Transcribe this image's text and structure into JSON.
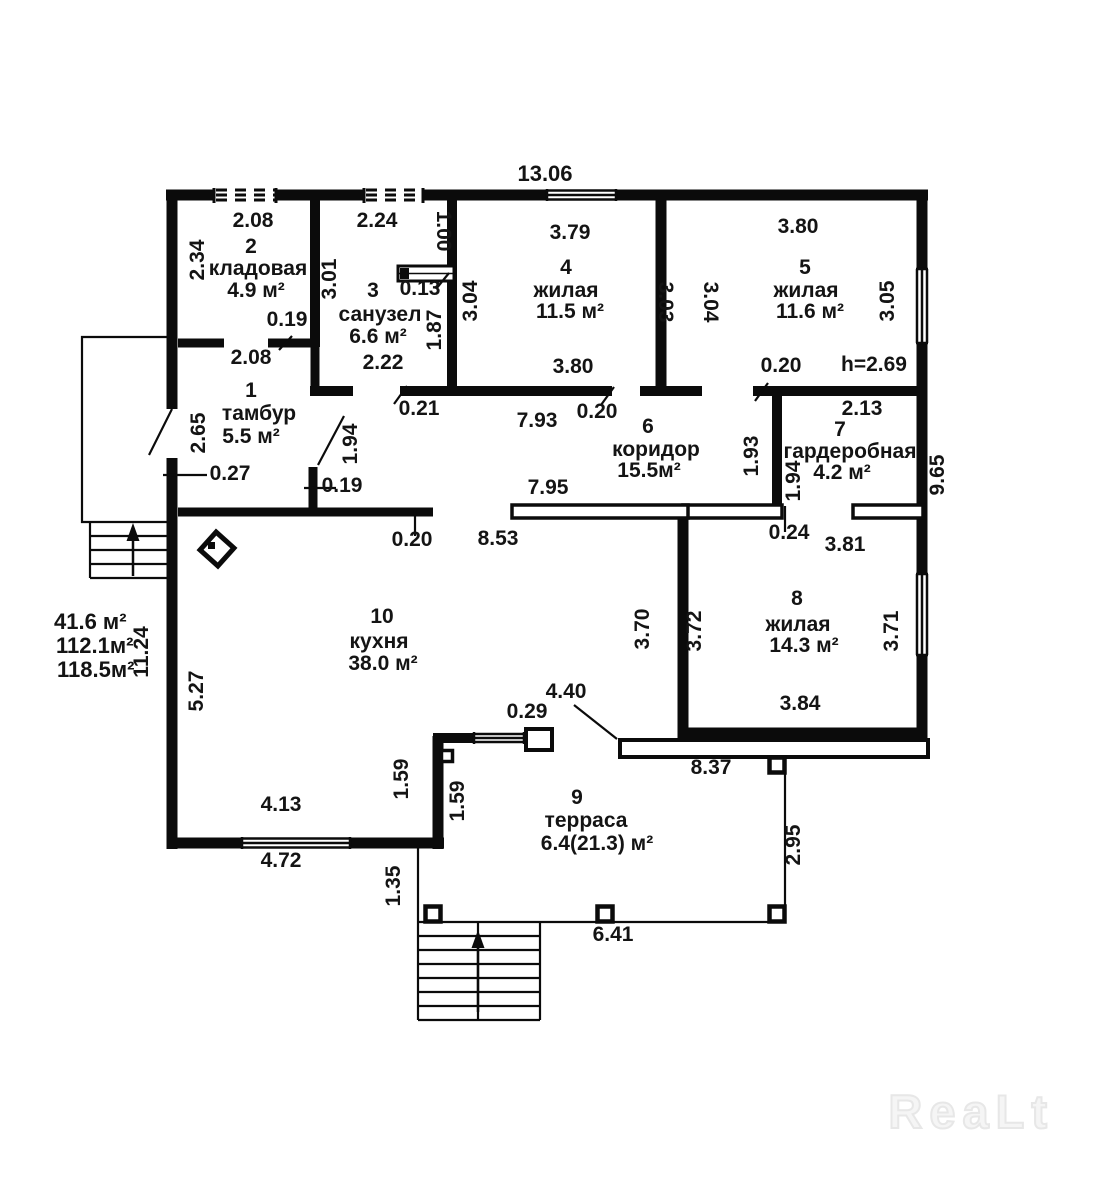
{
  "watermark": "ReaLt",
  "summary": {
    "building_areas": [
      "41.6 м²",
      "112.1м²",
      "118.5м²"
    ],
    "ceiling_height": "h=2.69"
  },
  "rooms": [
    {
      "number": "1",
      "name": "тамбур",
      "area": "5.5 м²"
    },
    {
      "number": "2",
      "name": "кладовая",
      "area": "4.9 м²"
    },
    {
      "number": "3",
      "name": "санузел",
      "area": "6.6 м²"
    },
    {
      "number": "4",
      "name": "жилая",
      "area": "11.5 м²"
    },
    {
      "number": "5",
      "name": "жилая",
      "area": "11.6 м²"
    },
    {
      "number": "6",
      "name": "коридор",
      "area": "15.5м²"
    },
    {
      "number": "7",
      "name": "гардеробная",
      "area": "4.2 м²"
    },
    {
      "number": "8",
      "name": "жилая",
      "area": "14.3 м²"
    },
    {
      "number": "9",
      "name": "терраса",
      "area": "6.4(21.3) м²"
    },
    {
      "number": "10",
      "name": "кухня",
      "area": "38.0 м²"
    }
  ],
  "labels": [
    {
      "t": "13.06",
      "x": 545,
      "y": 181,
      "s": 22
    },
    {
      "t": "2.08",
      "x": 253,
      "y": 227
    },
    {
      "t": "2.24",
      "x": 377,
      "y": 227
    },
    {
      "t": "1.00",
      "x": 437,
      "y": 231,
      "r": 90
    },
    {
      "t": "2.34",
      "x": 204,
      "y": 260,
      "r": -90
    },
    {
      "t": "2",
      "x": 251,
      "y": 253,
      "n": "room-number"
    },
    {
      "t": "кладовая",
      "x": 258,
      "y": 275,
      "n": "room-name"
    },
    {
      "t": "4.9 м²",
      "x": 256,
      "y": 297,
      "n": "room-area"
    },
    {
      "t": "3.01",
      "x": 336,
      "y": 279,
      "r": -90
    },
    {
      "t": "3",
      "x": 373,
      "y": 297,
      "n": "room-number"
    },
    {
      "t": "0.13",
      "x": 420,
      "y": 295
    },
    {
      "t": "санузел",
      "x": 380,
      "y": 321,
      "n": "room-name"
    },
    {
      "t": "6.6 м²",
      "x": 378,
      "y": 343,
      "n": "room-area"
    },
    {
      "t": "1.87",
      "x": 441,
      "y": 330,
      "r": -90
    },
    {
      "t": "0.19",
      "x": 287,
      "y": 326
    },
    {
      "t": "2.08",
      "x": 251,
      "y": 364
    },
    {
      "t": "2.22",
      "x": 383,
      "y": 369
    },
    {
      "t": "0.21",
      "x": 419,
      "y": 415
    },
    {
      "t": "1",
      "x": 251,
      "y": 397,
      "n": "room-number"
    },
    {
      "t": "тамбур",
      "x": 259,
      "y": 420,
      "n": "room-name"
    },
    {
      "t": "5.5 м²",
      "x": 251,
      "y": 443,
      "n": "room-area"
    },
    {
      "t": "2.65",
      "x": 205,
      "y": 433,
      "r": -90
    },
    {
      "t": "0.27",
      "x": 230,
      "y": 480
    },
    {
      "t": "1.94",
      "x": 357,
      "y": 444,
      "r": -90
    },
    {
      "t": "0.19",
      "x": 342,
      "y": 492
    },
    {
      "t": "3.04",
      "x": 477,
      "y": 301,
      "r": -90
    },
    {
      "t": "3.79",
      "x": 570,
      "y": 239
    },
    {
      "t": "4",
      "x": 566,
      "y": 274,
      "n": "room-number"
    },
    {
      "t": "жилая",
      "x": 566,
      "y": 297,
      "n": "room-name"
    },
    {
      "t": "11.5 м²",
      "x": 570,
      "y": 318,
      "n": "room-area"
    },
    {
      "t": "3.03",
      "x": 659,
      "y": 302,
      "r": 90
    },
    {
      "t": "3.04",
      "x": 704,
      "y": 302,
      "r": 90
    },
    {
      "t": "3.80",
      "x": 573,
      "y": 373
    },
    {
      "t": "0.20",
      "x": 597,
      "y": 418
    },
    {
      "t": "7.93",
      "x": 537,
      "y": 427
    },
    {
      "t": "3.80",
      "x": 798,
      "y": 233
    },
    {
      "t": "5",
      "x": 805,
      "y": 274,
      "n": "room-number"
    },
    {
      "t": "жилая",
      "x": 806,
      "y": 297,
      "n": "room-name"
    },
    {
      "t": "11.6 м²",
      "x": 810,
      "y": 318,
      "n": "room-area"
    },
    {
      "t": "3.05",
      "x": 894,
      "y": 301,
      "r": -90
    },
    {
      "t": "0.20",
      "x": 781,
      "y": 372
    },
    {
      "t": "h=2.69",
      "x": 874,
      "y": 371,
      "n": "ceiling-height"
    },
    {
      "t": "6",
      "x": 648,
      "y": 433,
      "n": "room-number"
    },
    {
      "t": "коридор",
      "x": 656,
      "y": 456,
      "n": "room-name"
    },
    {
      "t": "15.5м²",
      "x": 649,
      "y": 477,
      "n": "room-area"
    },
    {
      "t": "2.13",
      "x": 862,
      "y": 415
    },
    {
      "t": "7",
      "x": 840,
      "y": 436,
      "n": "room-number"
    },
    {
      "t": "гардеробная",
      "x": 850,
      "y": 458,
      "n": "room-name"
    },
    {
      "t": "4.2 м²",
      "x": 842,
      "y": 479,
      "n": "room-area"
    },
    {
      "t": "1.93",
      "x": 758,
      "y": 456,
      "r": -90
    },
    {
      "t": "1.94",
      "x": 800,
      "y": 481,
      "r": -90
    },
    {
      "t": "0.24",
      "x": 789,
      "y": 539
    },
    {
      "t": "3.81",
      "x": 845,
      "y": 551
    },
    {
      "t": "9.65",
      "x": 944,
      "y": 475,
      "r": -90
    },
    {
      "t": "0.20",
      "x": 412,
      "y": 546
    },
    {
      "t": "8.53",
      "x": 498,
      "y": 545
    },
    {
      "t": "7.95",
      "x": 548,
      "y": 494
    },
    {
      "t": "10",
      "x": 382,
      "y": 623,
      "n": "room-number"
    },
    {
      "t": "кухня",
      "x": 379,
      "y": 648,
      "n": "room-name"
    },
    {
      "t": "38.0 м²",
      "x": 383,
      "y": 670,
      "n": "room-area"
    },
    {
      "t": "5.27",
      "x": 203,
      "y": 691,
      "r": -90
    },
    {
      "t": "11.24",
      "x": 148,
      "y": 652,
      "r": -90
    },
    {
      "t": "41.6 м²",
      "x": 54,
      "y": 629,
      "s": 22,
      "a": "start",
      "n": "summary-area"
    },
    {
      "t": "112.1м²",
      "x": 56,
      "y": 653,
      "s": 22,
      "a": "start",
      "n": "summary-area"
    },
    {
      "t": "118.5м²",
      "x": 57,
      "y": 677,
      "s": 22,
      "a": "start",
      "n": "summary-area"
    },
    {
      "t": "3.70",
      "x": 649,
      "y": 629,
      "r": -90
    },
    {
      "t": "3.72",
      "x": 701,
      "y": 631,
      "r": -90
    },
    {
      "t": "8",
      "x": 797,
      "y": 605,
      "n": "room-number"
    },
    {
      "t": "жилая",
      "x": 798,
      "y": 631,
      "n": "room-name"
    },
    {
      "t": "14.3 м²",
      "x": 804,
      "y": 652,
      "n": "room-area"
    },
    {
      "t": "3.71",
      "x": 898,
      "y": 631,
      "r": -90
    },
    {
      "t": "3.84",
      "x": 800,
      "y": 710
    },
    {
      "t": "8.37",
      "x": 711,
      "y": 774
    },
    {
      "t": "2.95",
      "x": 800,
      "y": 845,
      "r": -90
    },
    {
      "t": "4.13",
      "x": 281,
      "y": 811
    },
    {
      "t": "4.72",
      "x": 281,
      "y": 867
    },
    {
      "t": "1.59",
      "x": 408,
      "y": 779,
      "r": -90
    },
    {
      "t": "1.59",
      "x": 464,
      "y": 801,
      "r": -90
    },
    {
      "t": "0.29",
      "x": 527,
      "y": 718
    },
    {
      "t": "4.40",
      "x": 566,
      "y": 698
    },
    {
      "t": "1.35",
      "x": 400,
      "y": 886,
      "r": -90
    },
    {
      "t": "9",
      "x": 577,
      "y": 804,
      "n": "room-number"
    },
    {
      "t": "терраса",
      "x": 586,
      "y": 827,
      "n": "room-name"
    },
    {
      "t": "6.4(21.3) м²",
      "x": 597,
      "y": 850,
      "n": "room-area"
    },
    {
      "t": "6.41",
      "x": 613,
      "y": 941
    }
  ]
}
